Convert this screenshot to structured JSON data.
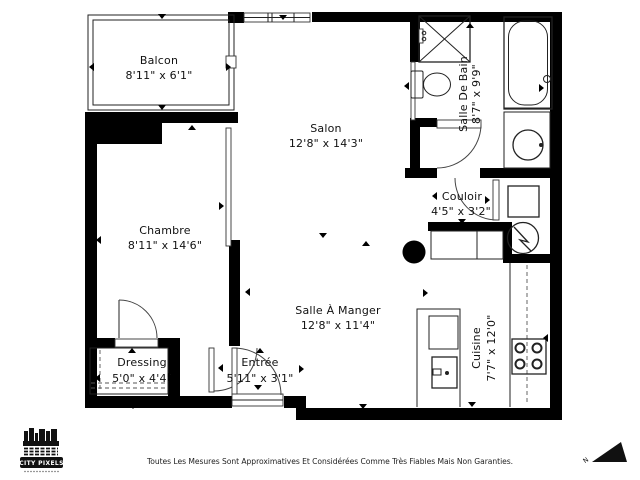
{
  "colors": {
    "background": "#ffffff",
    "wall": "#000000",
    "line": "#222222",
    "text": "#111111"
  },
  "rooms": {
    "balcon": {
      "name": "Balcon",
      "dims": "8'11\" x 6'1\""
    },
    "salon": {
      "name": "Salon",
      "dims": "12'8\" x 14'3\""
    },
    "salle_de_bain": {
      "name": "Salle De Bain",
      "dims": "8'7\" x 9'9\""
    },
    "couloir": {
      "name": "Couloir",
      "dims": "4'5\" x 3'2\""
    },
    "chambre": {
      "name": "Chambre",
      "dims": "8'11\" x 14'6\""
    },
    "salle_a_manger": {
      "name": "Salle À Manger",
      "dims": "12'8\" x 11'4\""
    },
    "dressing": {
      "name": "Dressing",
      "dims": "5'0\" x 4'4\""
    },
    "entree": {
      "name": "Entrée",
      "dims": "5'11\" x 3'1\""
    },
    "cuisine": {
      "name": "Cuisine",
      "dims": "7'7\" x 12'0\""
    }
  },
  "logo": {
    "title": "CITY PIXELS"
  },
  "compass": {
    "label": "N"
  },
  "footer": {
    "disclaimer": "Toutes Les Mesures Sont Approximatives Et Considérées Comme Très Fiables Mais Non Garanties."
  }
}
